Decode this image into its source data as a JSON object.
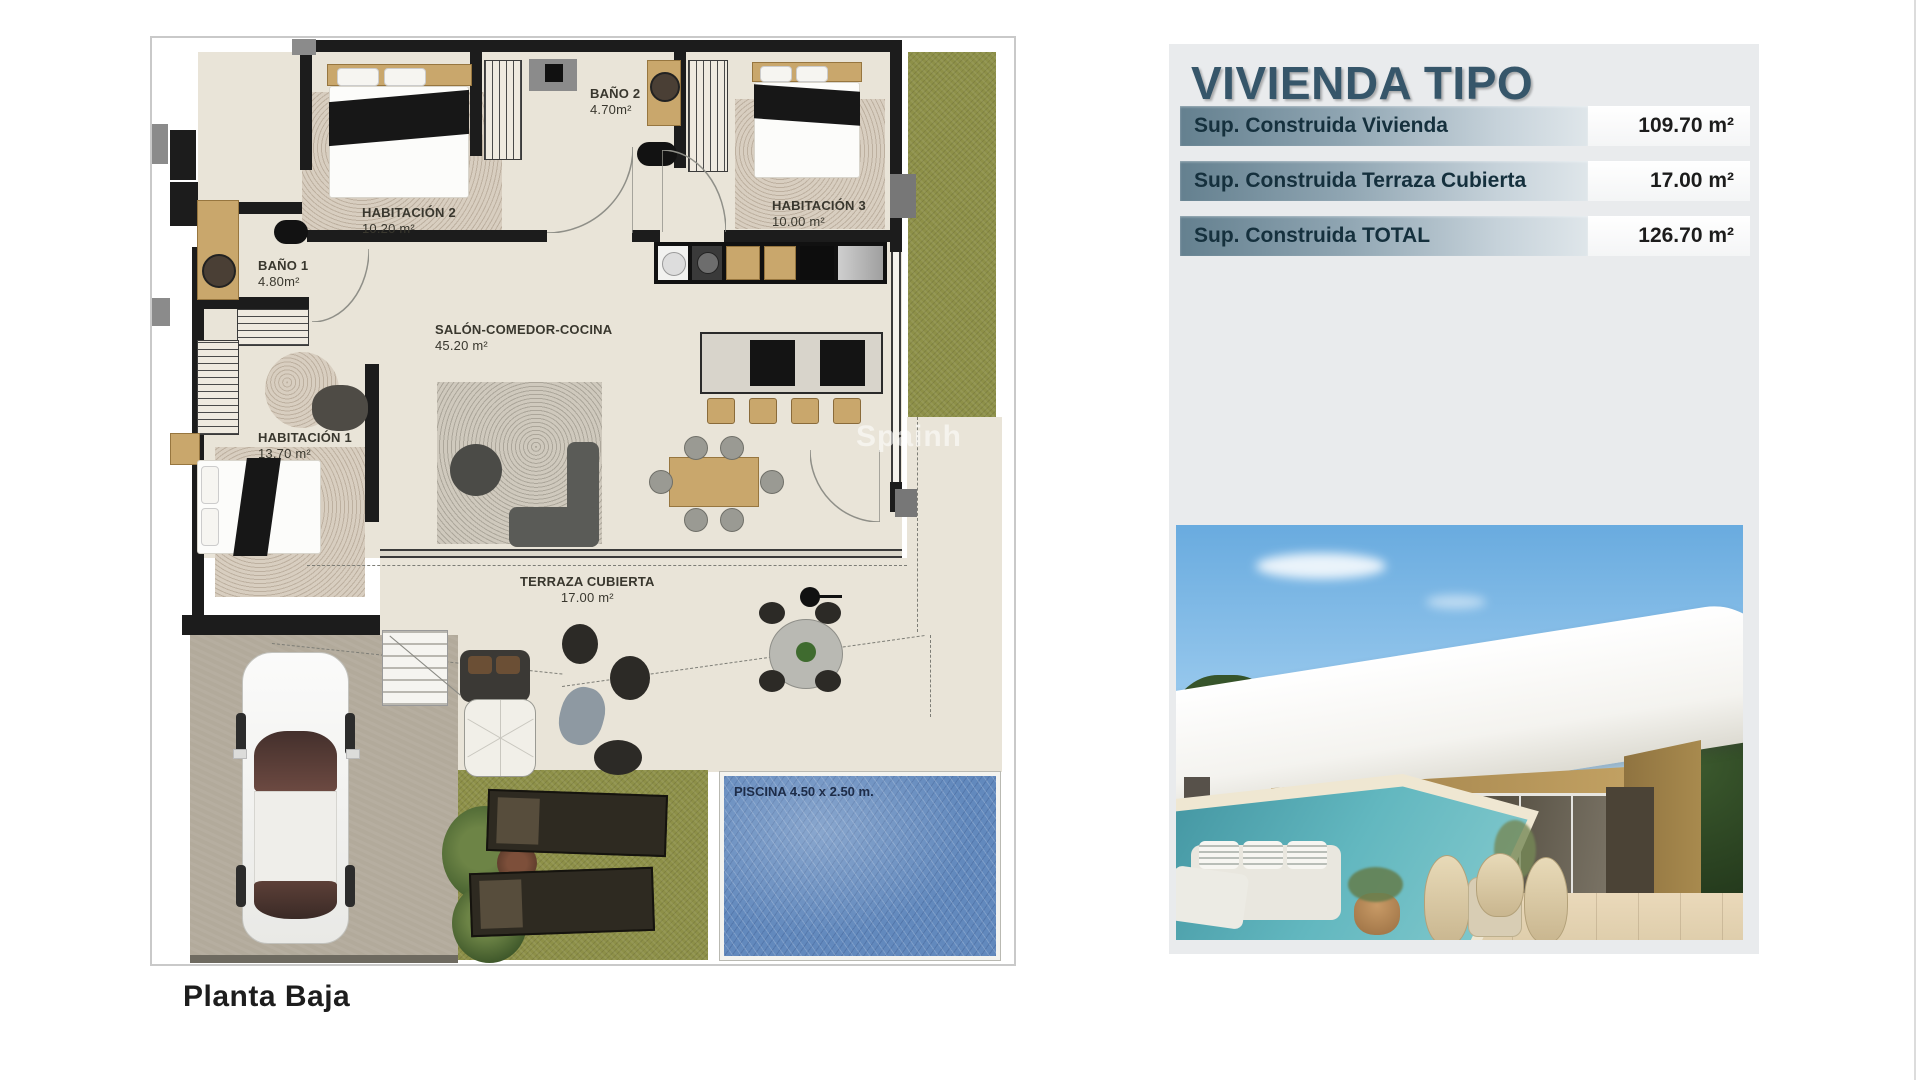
{
  "plan": {
    "caption": "Planta Baja",
    "watermark": "Spainh",
    "rooms": [
      {
        "id": "hab2",
        "name": "HABITACIÓN 2",
        "area": "10.20 m²"
      },
      {
        "id": "bano2",
        "name": "BAÑO 2",
        "area": "4.70m²"
      },
      {
        "id": "hab3",
        "name": "HABITACIÓN 3",
        "area": "10.00 m²"
      },
      {
        "id": "bano1",
        "name": "BAÑO 1",
        "area": "4.80m²"
      },
      {
        "id": "salon",
        "name": "SALÓN-COMEDOR-COCINA",
        "area": "45.20 m²"
      },
      {
        "id": "hab1",
        "name": "HABITACIÓN 1",
        "area": "13.70 m²"
      },
      {
        "id": "terraza",
        "name": "TERRAZA CUBIERTA",
        "area": "17.00 m²"
      }
    ],
    "pool_label": "PISCINA 4.50 x 2.50 m.",
    "colors": {
      "floor": "#e9e4d8",
      "wall": "#1c1c1c",
      "grass": "#8d9048",
      "pool": "#6289bd",
      "driveway": "#b2aa9b"
    }
  },
  "panel": {
    "title": "VIVIENDA TIPO",
    "rows": [
      {
        "label": "Sup. Construida Vivienda",
        "value": "109.70 m²"
      },
      {
        "label": "Sup. Construida Terraza Cubierta",
        "value": "17.00 m²"
      },
      {
        "label": "Sup. Construida TOTAL",
        "value": "126.70 m²"
      }
    ],
    "colors": {
      "panel_bg": "#e9ebed",
      "title": "#36566a",
      "bar_left": "#64808f",
      "bar_right": "#dfe6ea",
      "text": "#15303d"
    }
  },
  "photo": {
    "colors": {
      "sky": "#69abdf",
      "roof": "#ffffff",
      "wall": "#b3904f",
      "pool": "#62b7bf",
      "terrace": "#ead9ba"
    }
  }
}
